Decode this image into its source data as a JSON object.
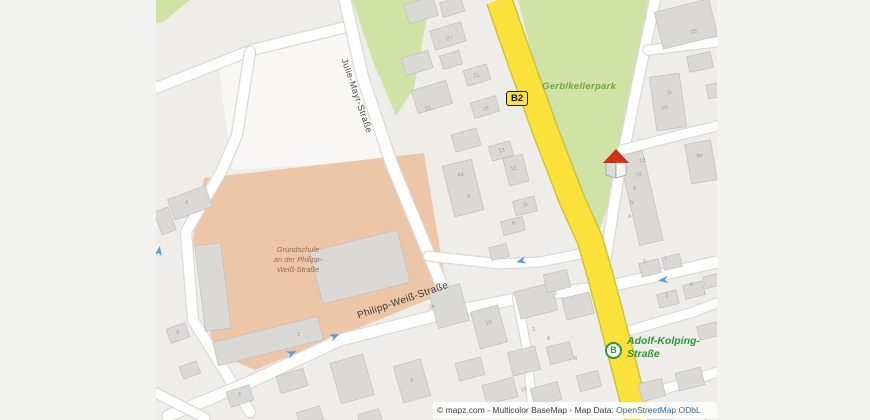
{
  "street_labels": {
    "julie": "Julie-Mayr-Straße",
    "philipp": "Philipp-Weiß-Straße",
    "adolf_line1": "Adolf-Kolping-",
    "adolf_line2": "Straße",
    "park": "Gerblkellerpark",
    "school_line1": "Grundschule",
    "school_line2": "an der Philipp-",
    "school_line3": "Weiß-Straße"
  },
  "badges": {
    "route": "B2",
    "bus_stop": "B"
  },
  "attribution": {
    "prefix": "© mapz.com - Multicolor BaseMap - Map Data: ",
    "link": "OpenStreetMap ODbL"
  },
  "map": {
    "style": {
      "margin_color": "#f2f2f1",
      "land_color": "#eeedea",
      "road_fill": "#ffffff",
      "road_casing": "#dad9d5",
      "main_road_fill": "#fbe23a",
      "main_road_casing": "#cdc23b",
      "building_fill": "#dbd9d6",
      "building_stroke": "#c1bfbb",
      "green_fill": "#cfe3a6",
      "school_fill": "#edc5a7",
      "parking_fill": "#f8f7f5",
      "number_color": "#98978f",
      "arrow_color": "#5b9bd5"
    },
    "areas": [
      {
        "name": "green-corner-nw",
        "fill": "#cfe3a6",
        "points": "156,0 190,0 163,22 156,24"
      },
      {
        "name": "green-patch-north",
        "fill": "#cfe3a6",
        "points": "352,0 430,0 414,88 396,116 374,64"
      },
      {
        "name": "gerblkellerpark-green",
        "fill": "#cfe3a6",
        "points": "518,0 648,0 616,180 596,242 578,232"
      },
      {
        "name": "parking-lot-nw",
        "fill": "#f8f7f5",
        "points": "218,64 345,33 388,160 232,170"
      },
      {
        "name": "school-grounds",
        "fill": "#edc5a7",
        "points": "204,178 424,153 447,292 255,370 214,352 193,240"
      }
    ],
    "roads": [
      {
        "name": "road-top-left",
        "w": 10,
        "points": "156,88 252,50 350,26"
      },
      {
        "name": "road-school-west",
        "w": 10,
        "points": "250,52 237,135 222,170 186,232 193,320 250,412"
      },
      {
        "name": "julie-mayr-strasse",
        "w": 11,
        "points": "345,0 362,75 392,165 425,245 450,305"
      },
      {
        "name": "cross-street-mid",
        "w": 9,
        "points": "428,256 500,264 540,262 585,253"
      },
      {
        "name": "philipp-weiss-strasse",
        "w": 11,
        "points": "168,416 250,382 340,340 450,312 540,294 600,288 660,275 717,262"
      },
      {
        "name": "road-corner-sw",
        "w": 9,
        "points": "156,393 205,418"
      },
      {
        "name": "alley-south",
        "w": 8,
        "points": "517,297 527,350 532,404"
      },
      {
        "name": "road-park-east",
        "w": 10,
        "points": "655,0 636,90 618,180 601,287"
      },
      {
        "name": "road-ne-upper",
        "w": 9,
        "points": "648,50 700,44 717,42"
      },
      {
        "name": "road-ne-lower",
        "w": 9,
        "points": "622,150 680,135 717,126"
      },
      {
        "name": "road-south-of-b2",
        "w": 10,
        "points": "601,287 612,330 625,380 634,420"
      },
      {
        "name": "road-se-1",
        "w": 9,
        "points": "614,335 690,313 717,303"
      },
      {
        "name": "road-se-2",
        "w": 9,
        "points": "630,400 700,378 717,372"
      }
    ],
    "main_road": {
      "name": "b2-road",
      "w": 24,
      "points": "499,0 520,60 545,130 572,200 590,240 600,275 612,320 625,370 638,420"
    },
    "buildings": [
      [
        421,
        10,
        30,
        20,
        -17
      ],
      [
        452,
        7,
        22,
        15,
        -17
      ],
      [
        448,
        36,
        32,
        20,
        -17
      ],
      [
        417,
        63,
        28,
        18,
        -17
      ],
      [
        451,
        60,
        20,
        14,
        -17
      ],
      [
        477,
        75,
        24,
        16,
        -17
      ],
      [
        432,
        97,
        36,
        24,
        -17
      ],
      [
        485,
        107,
        26,
        16,
        -17
      ],
      [
        466,
        140,
        26,
        18,
        -16
      ],
      [
        501,
        151,
        22,
        15,
        -16
      ],
      [
        463,
        188,
        30,
        52,
        -14
      ],
      [
        516,
        170,
        20,
        28,
        -14
      ],
      [
        525,
        206,
        22,
        15,
        -14
      ],
      [
        513,
        226,
        22,
        14,
        -14
      ],
      [
        499,
        252,
        18,
        13,
        -14
      ],
      [
        213,
        287,
        26,
        86,
        -7
      ],
      [
        268,
        341,
        108,
        24,
        -14
      ],
      [
        360,
        267,
        90,
        54,
        -14
      ],
      [
        190,
        203,
        40,
        22,
        -20
      ],
      [
        165,
        221,
        15,
        24,
        -20
      ],
      [
        641,
        198,
        24,
        92,
        -13
      ],
      [
        686,
        24,
        56,
        38,
        -14
      ],
      [
        668,
        102,
        30,
        54,
        -8
      ],
      [
        701,
        162,
        26,
        40,
        -10
      ],
      [
        700,
        62,
        24,
        16,
        -12
      ],
      [
        717,
        90,
        20,
        14,
        -12
      ],
      [
        449,
        306,
        32,
        38,
        -15
      ],
      [
        489,
        327,
        28,
        38,
        -15
      ],
      [
        536,
        301,
        38,
        28,
        -14
      ],
      [
        557,
        281,
        24,
        18,
        -14
      ],
      [
        578,
        306,
        28,
        22,
        -14
      ],
      [
        524,
        361,
        28,
        24,
        -14
      ],
      [
        560,
        353,
        24,
        18,
        -14
      ],
      [
        470,
        369,
        26,
        18,
        -15
      ],
      [
        500,
        391,
        32,
        20,
        -15
      ],
      [
        546,
        394,
        28,
        18,
        -15
      ],
      [
        589,
        381,
        22,
        16,
        -14
      ],
      [
        178,
        333,
        20,
        15,
        -20
      ],
      [
        190,
        370,
        18,
        13,
        -20
      ],
      [
        240,
        396,
        24,
        16,
        -18
      ],
      [
        292,
        381,
        28,
        18,
        -17
      ],
      [
        352,
        379,
        34,
        42,
        -16
      ],
      [
        412,
        381,
        28,
        38,
        -16
      ],
      [
        310,
        416,
        24,
        14,
        -16
      ],
      [
        370,
        418,
        22,
        13,
        -16
      ],
      [
        650,
        268,
        20,
        14,
        -14
      ],
      [
        672,
        262,
        18,
        13,
        -14
      ],
      [
        668,
        299,
        20,
        14,
        -14
      ],
      [
        694,
        290,
        20,
        14,
        -14
      ],
      [
        712,
        281,
        16,
        12,
        -14
      ],
      [
        652,
        390,
        24,
        18,
        -14
      ],
      [
        690,
        379,
        26,
        18,
        -14
      ],
      [
        708,
        331,
        20,
        14,
        -14
      ],
      [
        714,
        410,
        22,
        14,
        -14
      ],
      [
        660,
        420,
        24,
        16,
        -14
      ]
    ],
    "house_numbers": [
      [
        450,
        40,
        "27"
      ],
      [
        477,
        77,
        "21"
      ],
      [
        428,
        110,
        "10"
      ],
      [
        486,
        110,
        "18"
      ],
      [
        461,
        176,
        "4a"
      ],
      [
        469,
        198,
        "4"
      ],
      [
        502,
        152,
        "13"
      ],
      [
        514,
        170,
        "12"
      ],
      [
        526,
        206,
        "11"
      ],
      [
        514,
        225,
        "9"
      ],
      [
        694,
        33,
        "15"
      ],
      [
        670,
        94,
        "11"
      ],
      [
        665,
        109,
        "10"
      ],
      [
        700,
        157,
        "8a"
      ],
      [
        643,
        162,
        "12"
      ],
      [
        639,
        176,
        "10"
      ],
      [
        635,
        190,
        "8"
      ],
      [
        632,
        204,
        "6"
      ],
      [
        630,
        218,
        "4"
      ],
      [
        645,
        263,
        "2"
      ],
      [
        666,
        260,
        "1"
      ],
      [
        667,
        297,
        "3"
      ],
      [
        692,
        286,
        "6"
      ],
      [
        432,
        308,
        "1b"
      ],
      [
        489,
        324,
        "10"
      ],
      [
        534,
        331,
        "3"
      ],
      [
        549,
        340,
        "8"
      ],
      [
        556,
        295,
        "2"
      ],
      [
        524,
        391,
        "10"
      ],
      [
        576,
        360,
        "9"
      ],
      [
        299,
        336,
        "2"
      ],
      [
        187,
        204,
        "4"
      ],
      [
        178,
        334,
        "3"
      ],
      [
        240,
        396,
        "2"
      ],
      [
        412,
        382,
        "4"
      ]
    ],
    "arrows": [
      [
        521,
        261,
        165
      ],
      [
        663,
        280,
        175
      ],
      [
        292,
        353,
        -24
      ],
      [
        335,
        336,
        -24
      ],
      [
        159,
        251,
        -80
      ]
    ]
  }
}
